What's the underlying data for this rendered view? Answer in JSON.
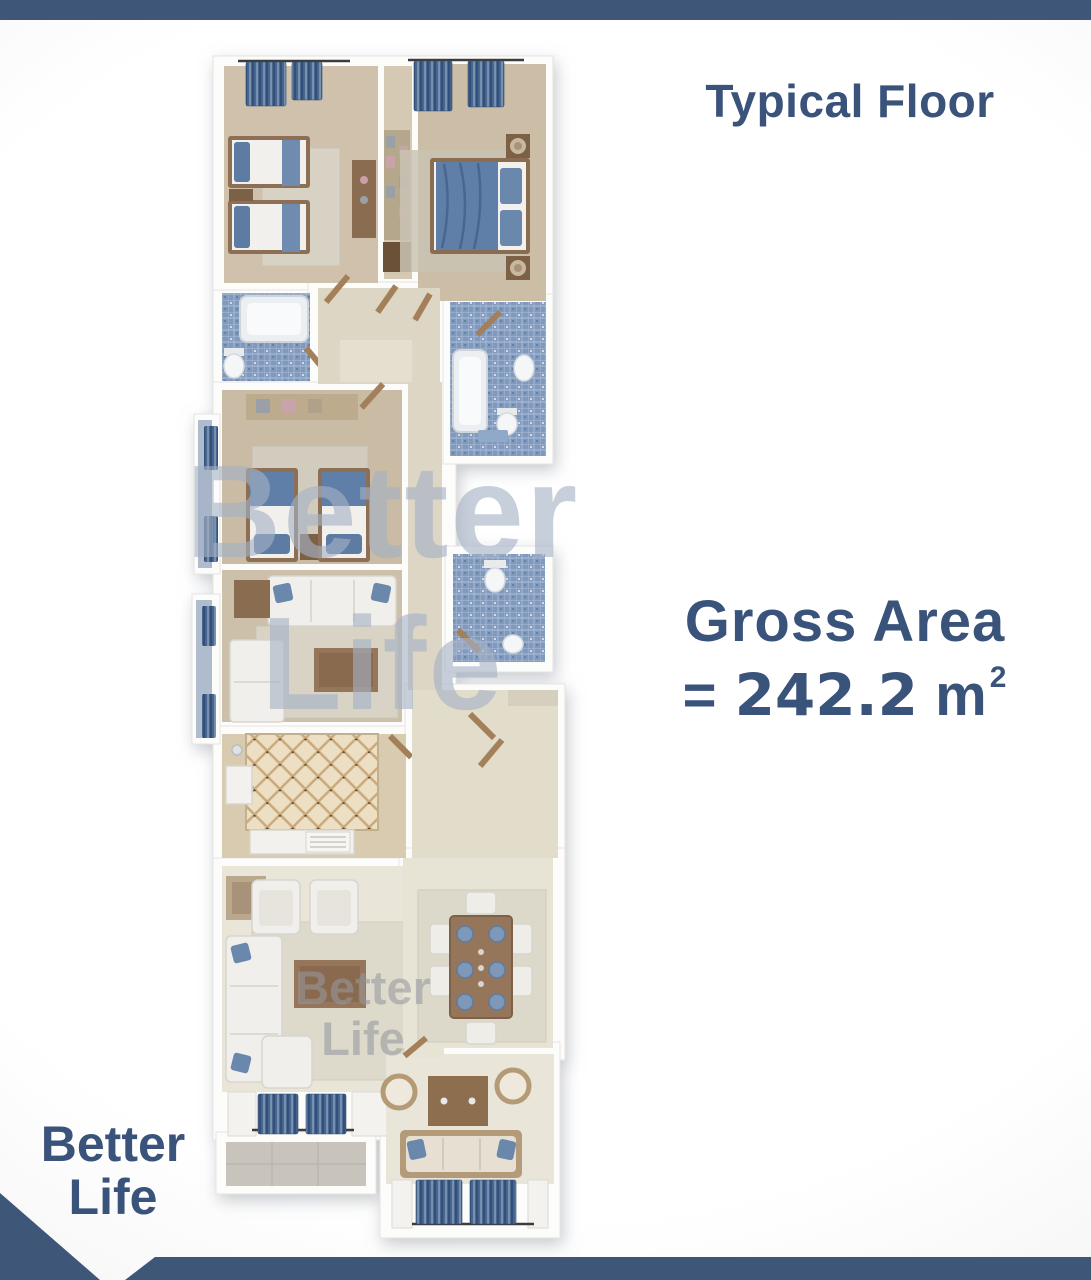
{
  "poster": {
    "title": "Typical Floor",
    "gross_area": {
      "label": "Gross Area",
      "equals": "=",
      "value": "242.2",
      "unit": "m",
      "exponent": "2"
    },
    "brand": {
      "line1": "Better",
      "line2": "Life"
    },
    "watermark_large": {
      "line1": "Better",
      "line2": "Life"
    },
    "watermark_small": {
      "line1": "Better",
      "line2": "Life"
    },
    "colors": {
      "navy": "#3e5677",
      "text_navy": "#3a537a",
      "watermark_blue": "#a4b2c5",
      "bathroom_tile_blue": "#8099bf",
      "curtain_blue": "#4a688f",
      "wood_brown": "#96765a",
      "floor_beige": "#cec0aa"
    }
  }
}
